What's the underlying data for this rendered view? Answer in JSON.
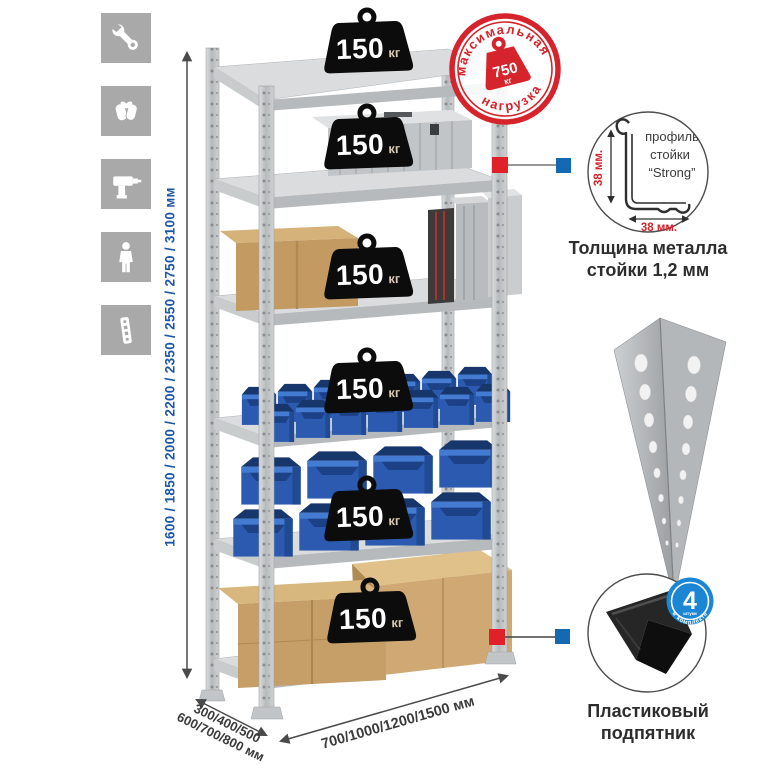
{
  "assembly_icons": [
    {
      "name": "wrench"
    },
    {
      "name": "gloves"
    },
    {
      "name": "drill"
    },
    {
      "name": "person"
    },
    {
      "name": "upright-post"
    }
  ],
  "dimensions": {
    "height": "1600 / 1850 / 2000 / 2200 / 2350 / 2550 / 2750 / 3100 мм",
    "depth_line1": "300/400/500",
    "depth_line2": "600/700/800 мм",
    "width": "700/1000/1200/1500 мм"
  },
  "shelves": [
    {
      "load": "150",
      "unit": "кг"
    },
    {
      "load": "150",
      "unit": "кг"
    },
    {
      "load": "150",
      "unit": "кг"
    },
    {
      "load": "150",
      "unit": "кг"
    },
    {
      "load": "150",
      "unit": "кг"
    },
    {
      "load": "150",
      "unit": "кг"
    }
  ],
  "stamp": {
    "arc_top": "максимальная",
    "arc_bottom": "нагрузка",
    "value": "750",
    "unit": "кг"
  },
  "profile_detail": {
    "line1": "профиль",
    "line2": "стойки",
    "line3": "“Strong”",
    "dim_vertical": "38 мм.",
    "dim_horizontal": "38 мм.",
    "caption1": "Толщина металла",
    "caption2": "стойки 1,2 мм"
  },
  "foot_detail": {
    "count": "4",
    "count_sub": "штуки",
    "badge_arc": "в комплекте",
    "caption1": "Пластиковый",
    "caption2": "подпятник"
  },
  "colors": {
    "accent_red": "#d6242c",
    "dim_blue": "#1c56a5",
    "marker_red": "#e02127",
    "marker_blue": "#1569b3",
    "bin_blue": "#2b5ab0",
    "icon_gray": "#a9a9a9"
  }
}
